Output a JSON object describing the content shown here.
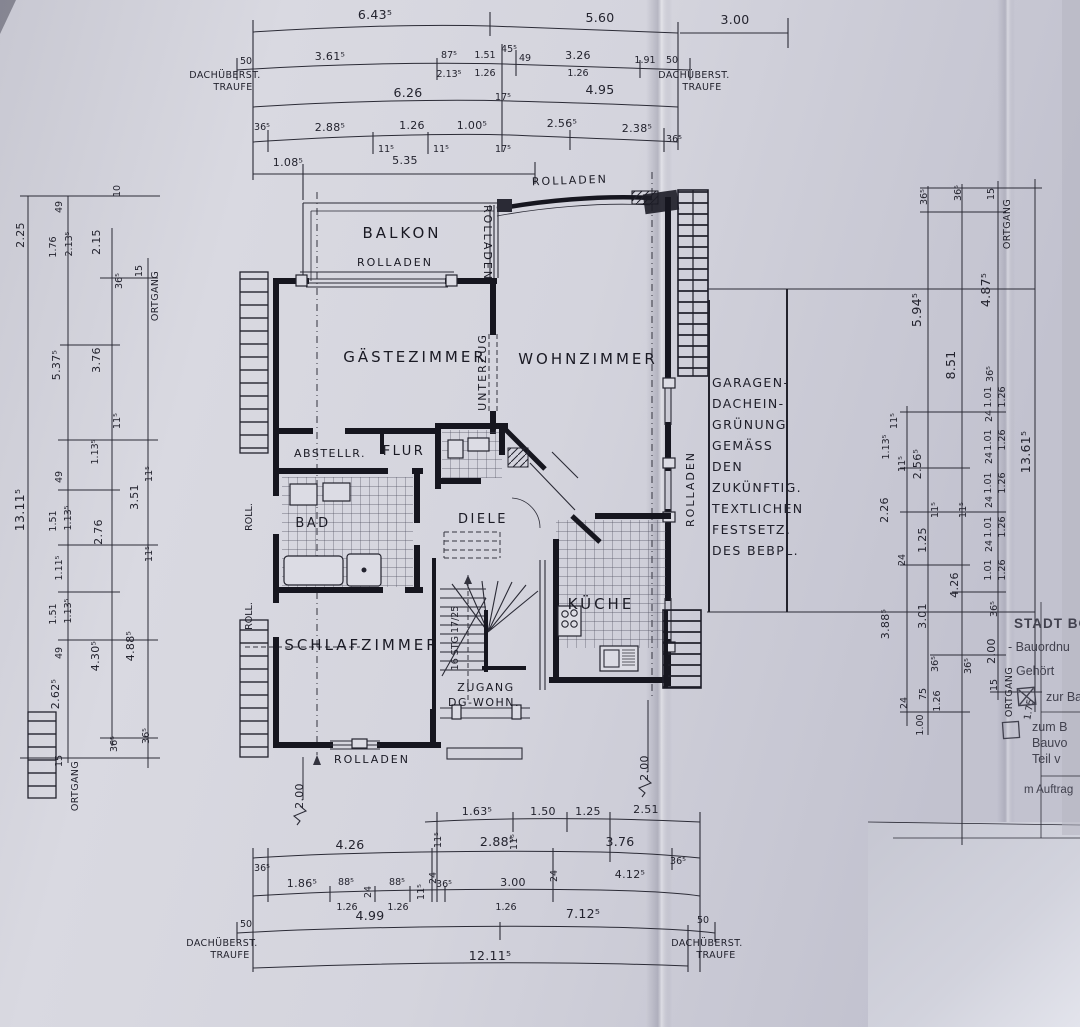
{
  "rooms": {
    "balkon": "BALKON",
    "gaestezimmer": "GÄSTEZIMMER",
    "wohnzimmer": "WOHNZIMMER",
    "schlafzimmer": "SCHLAFZIMMER",
    "kueche": "KÜCHE",
    "bad": "BAD",
    "flur": "FLUR",
    "diele": "DIELE",
    "abstellraum": "ABSTELLR.",
    "zugang_line1": "ZUGANG",
    "zugang_line2": "DG-WOHN.",
    "stair_note": "16 STG 17/25"
  },
  "labels": {
    "rolladen": "ROLLADEN",
    "roll": "ROLL.",
    "unterzug": "UNTERZUG",
    "ortgang": "ORTGANG",
    "traufe_line1": "DACHÜBERST.",
    "traufe_line2": "TRAUFE"
  },
  "note": {
    "l1": "GARAGEN-",
    "l2": "DACHEIN-",
    "l3": "GRÜNUNG",
    "l4": "GEMÄSS",
    "l5": "DEN",
    "l6": "ZUKÜNFTIG.",
    "l7": "TEXTLICHEN",
    "l8": "FESTSETZ.",
    "l9": "DES BEBPL."
  },
  "stamp": {
    "title": "STADT BO",
    "line1": "- Bauordnu",
    "gehoert": "Gehört",
    "zur": "zur Ba",
    "zum": "zum B",
    "bauvo": "Bauvo",
    "teil": "Teil v",
    "auftrag": "m Auftrag"
  },
  "dims": {
    "t": [
      "6.43⁵",
      "5.60",
      "3.00",
      "50",
      "3.61⁵",
      "87⁵",
      "2.13⁵",
      "1.51",
      "1.26",
      "45⁵",
      "49",
      "3.26",
      "1.26",
      "1.91",
      "50",
      "6.26",
      "17⁵",
      "4.95",
      "36⁵",
      "2.88⁵",
      "11⁵",
      "1.26",
      "11⁵",
      "1.00⁵",
      "17⁵",
      "2.56⁵",
      "2.38⁵",
      "36⁵",
      "1.08⁵",
      "5.35"
    ],
    "l": [
      "2.25",
      "13.11⁵",
      "49",
      "1.76",
      "2.13⁵",
      "5.37⁵",
      "49",
      "1.51",
      "1.13⁵",
      "1.11⁵",
      "1.51",
      "1.13⁵",
      "49",
      "2.62⁵",
      "15",
      "10",
      "2.15",
      "36⁵",
      "3.76",
      "11⁵",
      "1.13⁵",
      "11⁵",
      "2.76",
      "4.30⁵",
      "36⁵",
      "15",
      "3.51",
      "11⁵",
      "4.88⁵",
      "36⁵"
    ],
    "r": [
      "36⁵",
      "36⁵",
      "15",
      "5.94⁵",
      "8.51",
      "4.87⁵",
      "36⁵",
      "1.01",
      "1.26",
      "24",
      "11⁵",
      "1.13⁵",
      "11⁵",
      "2.56⁵",
      "2.26",
      "1.01",
      "1.26",
      "24",
      "11⁵",
      "11⁵",
      "1.25",
      "24",
      "1.01",
      "1.26",
      "24",
      "1.01",
      "1.26",
      "24",
      "1.01",
      "1.26",
      "4.26",
      "3.01",
      "3.88⁵",
      "36⁵",
      "2.00",
      "15",
      "36⁵",
      "36⁵",
      "24",
      "75",
      "1.26",
      "1.00",
      "13.61⁵",
      "1.75"
    ],
    "b": [
      "11⁵",
      "1.63⁵",
      "11⁵",
      "1.50",
      "1.25",
      "2.51",
      "36⁵",
      "4.26",
      "24",
      "2.88⁵",
      "24",
      "3.76",
      "36⁵",
      "1.86⁵",
      "88⁵",
      "1.26",
      "24",
      "88⁵",
      "1.26",
      "11⁵",
      "36⁵",
      "3.00",
      "1.26",
      "4.12⁵",
      "50",
      "4.99",
      "7.12⁵",
      "50",
      "12.11⁵",
      "2.00",
      "2.00"
    ]
  }
}
